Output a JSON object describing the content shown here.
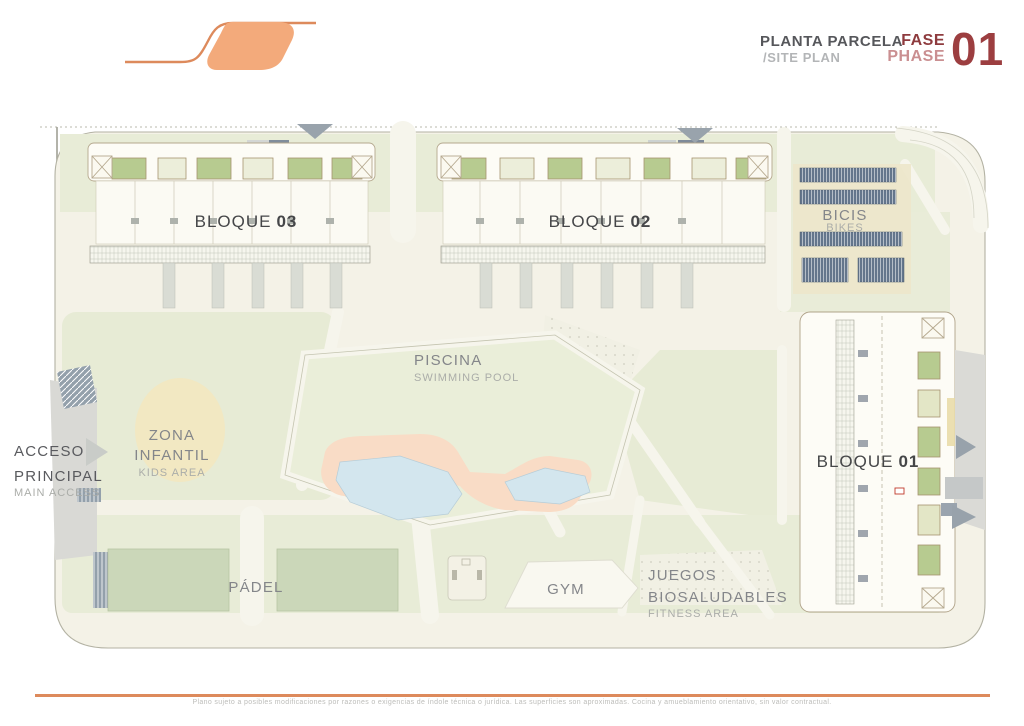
{
  "header": {
    "plan_title_es": "PLANTA PARCELA",
    "plan_title_en": "/SITE PLAN",
    "phase_es": "FASE",
    "phase_en": "PHASE",
    "phase_number": "01"
  },
  "plan": {
    "blocks": [
      {
        "label": "BLOQUE",
        "number": "03"
      },
      {
        "label": "BLOQUE",
        "number": "02"
      },
      {
        "label": "BLOQUE",
        "number": "01"
      }
    ],
    "areas": {
      "piscina": {
        "es": "PISCINA",
        "en": "SWIMMING POOL"
      },
      "zona_infantil": {
        "es_line1": "ZONA",
        "es_line2": "INFANTIL",
        "en": "KIDS AREA"
      },
      "padel": {
        "es": "PÁDEL"
      },
      "gym": {
        "es": "GYM"
      },
      "juegos": {
        "es_line1": "JUEGOS",
        "es_line2": "BIOSALUDABLES",
        "en": "FITNESS AREA"
      },
      "bicis": {
        "es": "BICIS",
        "en": "BIKES"
      },
      "acceso": {
        "es_line1": "ACCESO",
        "es_line2": "PRINCIPAL",
        "en": "MAIN ACCESS"
      }
    }
  },
  "footer": {
    "disclaimer": "Plano sujeto a posibles modificaciones por razones o exigencias de índole técnica o jurídica. Las superficies son aproximadas. Cocina y amueblamiento orientativo, sin valor contractual."
  },
  "colors": {
    "accent_orange_fill": "#F3AA7B",
    "accent_orange_line": "#DD8A5C",
    "phase_dark_red": "#9C3E40",
    "phase_light_red": "#CA8F91",
    "title_gray": "#56575B",
    "subtitle_gray": "#B3B5B7",
    "parcel_ivory": "#F4F2E7",
    "lawn_green": "#E8ECD7",
    "court_green": "#CBD7B9",
    "roof_green": "#B7CB90",
    "pool_blue": "#D3E6EE",
    "deck_salmon": "#F9DCC6",
    "bike_slate": "#64768C",
    "road_gray": "#D9D9D5"
  }
}
